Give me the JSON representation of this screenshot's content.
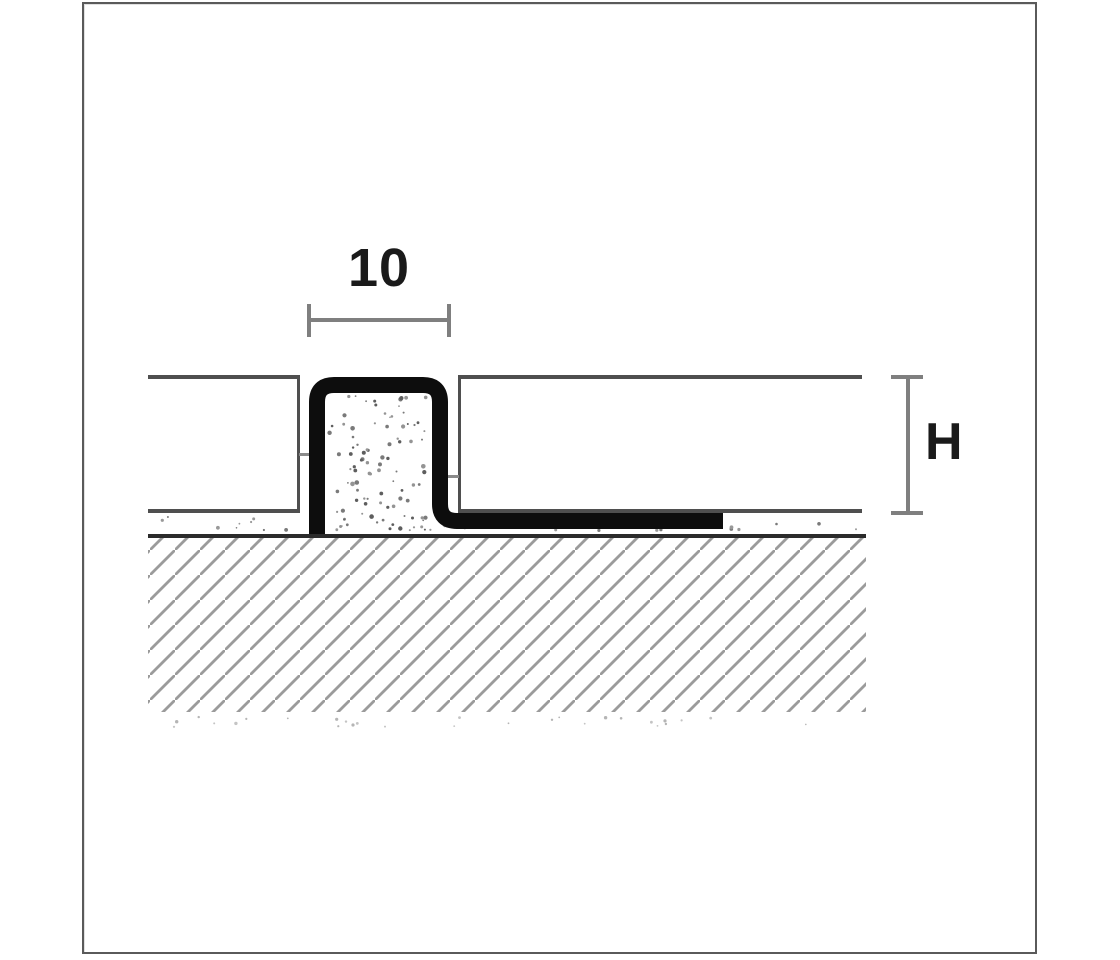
{
  "diagram": {
    "name": "expansion-joint-tile-profile-cross-section",
    "labels": {
      "joint_width": "10",
      "height": "H"
    },
    "colors": {
      "background": "#ffffff",
      "frame_border": "#5a5a5a",
      "label_color": "#1a1a1a",
      "dimension_gray": "#7f7f7f",
      "tile_outline": "#4f4f4f",
      "profile_black": "#0d0d0d",
      "substrate_line": "#2b2b2b",
      "hatch_gray": "#9b9b9b",
      "speckle_gray": "#7a7a7a",
      "speckle_faint": "#c4c4c4"
    }
  }
}
